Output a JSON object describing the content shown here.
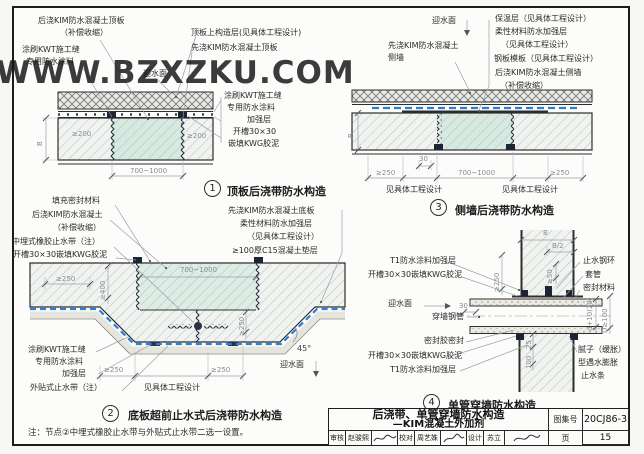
{
  "watermark": "WWW.BZXZKU.COM",
  "colors": {
    "membrane_blue": "#2b7fd6",
    "concrete_teal": "#d7eae1",
    "line": "#2d2d2d",
    "dim_gray": "#868d95"
  },
  "details": {
    "d1": {
      "number": "1",
      "title": "顶板后浇带防水构造",
      "labels": {
        "houjiao_top": "后浇KIM防水混凝土顶板",
        "buchang": "（补偿收缩）",
        "tushua1": "涂刷KWT施工缝",
        "zhuanyong1": "专用防水涂料",
        "yingshuimian": "迎水面",
        "gouzaoceng": "顶板上构造层(见具体工程设计)",
        "xianjiao_top": "先浇KIM防水混凝土顶板",
        "tushua2": "涂刷KWT施工缝",
        "zhuanyong2": "专用防水涂料",
        "jiaqiangceng": "加强层",
        "kaicao": "开槽30×30",
        "qiantian": "嵌填KWG胶泥"
      },
      "dims": {
        "w1": "≥200",
        "w2": "≥200",
        "b": "B",
        "span": "700~1000"
      }
    },
    "d3": {
      "number": "3",
      "title": "侧墙后浇带防水构造",
      "labels": {
        "yingshuimian": "迎水面",
        "baowen": "保温层（见具体工程设计）",
        "rouxing": "柔性材料防水加强层",
        "jianjuti1": "（见具体工程设计）",
        "gangban": "钢板模板（见具体工程设计）",
        "houjiao": "后浇KIM防水混凝土侧墙",
        "buchang": "（补偿收缩）",
        "xianjiao": "先浇KIM防水混凝土",
        "ceqiang": "侧墙"
      },
      "dims": {
        "b": "B",
        "c30": "30",
        "l250": "≥250",
        "span": "700~1000",
        "r250": "≥250",
        "jl": "见具体工程设计",
        "jr": "见具体工程设计"
      }
    },
    "d2": {
      "number": "2",
      "title": "底板超前止水式后浇带防水构造",
      "labels": {
        "tianchong": "填充密封材料",
        "houjiao": "后浇KIM防水混凝土",
        "buchang": "（补偿收缩）",
        "zhongmai": "中埋式橡胶止水带（注）",
        "kaicao": "开槽30×30嵌填KWG胶泥",
        "xianjiao": "先浇KIM防水混凝土底板",
        "rouxing": "柔性材料防水加强层",
        "jianjuti": "（见具体工程设计）",
        "dianceng": "≥100厚C15混凝土垫层",
        "tushua": "涂刷KWT施工缝",
        "zhuanyong": "专用防水涂料",
        "jiaqiang": "加强层",
        "waitie": "外贴式止水带（注）",
        "yingshuimian": "迎水面"
      },
      "dims": {
        "l250": "≥250",
        "span": "700~1000",
        "v400": "≥400",
        "v250": "≥250",
        "b250l": "≥250",
        "b250r": "≥250",
        "jj": "见具体工程设计",
        "angle": "45°"
      }
    },
    "d4": {
      "number": "4",
      "title": "单管穿墙防水构造",
      "labels": {
        "t1_top": "T1防水涂料加强层",
        "kaicao_top": "开槽30×30嵌填KWG胶泥",
        "yingshuimian": "迎水面",
        "gangguan": "穿墙钢管",
        "mifengjiao": "密封胶密封",
        "kaicao_bot": "开槽30×30嵌填KWG胶泥",
        "t1_bot": "T1防水涂料加强层",
        "zhishuigh": "止水钢环",
        "taoguan": "套管",
        "mifengcl": "密封材料",
        "nizi1": "腻子（缓胀）",
        "nizi2": "型遇水膨胀",
        "nizi3": "止水条"
      },
      "dims": {
        "b": "B",
        "b2": "B/2",
        "g50": "≥50",
        "v250": "≥250",
        "c30": "30",
        "d25": "25",
        "d100": "100",
        "dpipe": "d+10(20)",
        "Dpipe": "D≥100"
      }
    }
  },
  "note": "注：节点②中埋式橡胶止水带与外贴式止水带二选一设置。",
  "titleblock": {
    "title_line1": "后浇带、单管穿墙防水构造",
    "title_line2": "—KIM混凝土外加剂",
    "atlas_label": "图集号",
    "atlas_no": "20CJ86-3",
    "page_label": "页",
    "page_no": "15",
    "row": {
      "shenhe_label": "审核",
      "shenhe_name": "赵骏熙",
      "jiaodui_label": "校对",
      "jiaodui_name": "周艺姝",
      "sheji_label": "设计",
      "sheji_name": "苏立"
    }
  }
}
